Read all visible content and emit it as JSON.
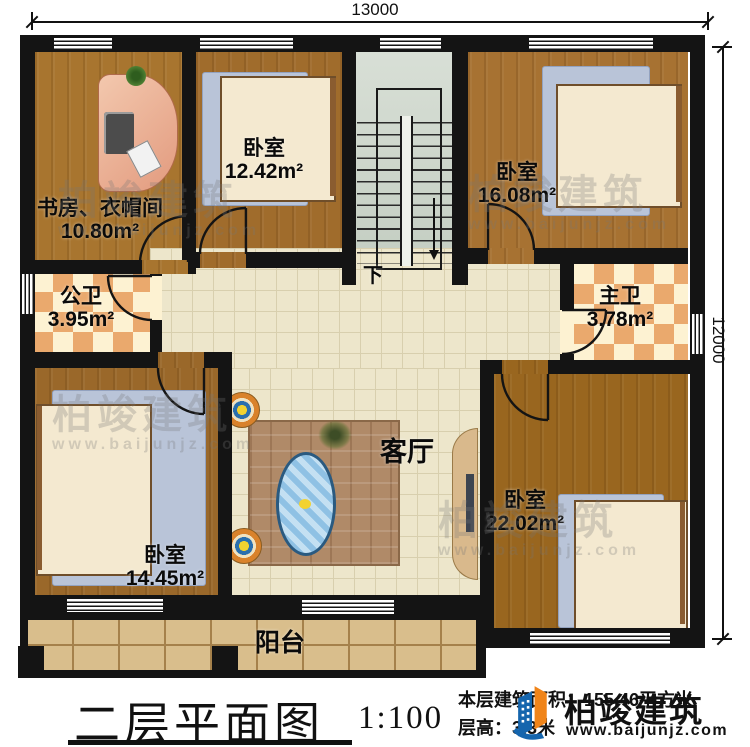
{
  "dimensions": {
    "width": "13000",
    "height": "12000"
  },
  "stairs": {
    "direction_label": "下"
  },
  "rooms": {
    "study": {
      "name": "书房、衣帽间",
      "area": "10.80m²"
    },
    "bedroom_top_left": {
      "name": "卧室",
      "area": "12.42m²"
    },
    "bedroom_top_right": {
      "name": "卧室",
      "area": "16.08m²"
    },
    "public_bathroom": {
      "name": "公卫",
      "area": "3.95m²"
    },
    "master_bathroom": {
      "name": "主卫",
      "area": "3.78m²"
    },
    "bedroom_bottom_left": {
      "name": "卧室",
      "area": "14.45m²"
    },
    "bedroom_bottom_right": {
      "name": "卧室",
      "area": "22.02m²"
    },
    "living_room": {
      "name": "客厅"
    },
    "balcony": {
      "name": "阳台"
    }
  },
  "title_block": {
    "title": "二层平面图",
    "scale": "1:100",
    "floor_area": "本层建筑面积：155.46平方米",
    "floor_height": "层高：3.3米"
  },
  "brand": {
    "name": "柏竣建筑",
    "website": "www.baijunjz.com"
  },
  "watermark": {
    "name": "柏竣建筑",
    "website": "www.baijunjz.com"
  },
  "colors": {
    "wall": "#141414",
    "wood_floor": "#a06c2c",
    "tile_floor": "#ede6cb",
    "balcony_floor": "#d9be8c",
    "stair_floor": "#ccd4c7",
    "bath_tile": "#eaa96d",
    "rug_blue": "#b9c4d8",
    "sofa_pink": "#f2bfa6",
    "logo_blue": "#1565ad",
    "logo_orange": "#f08419"
  }
}
